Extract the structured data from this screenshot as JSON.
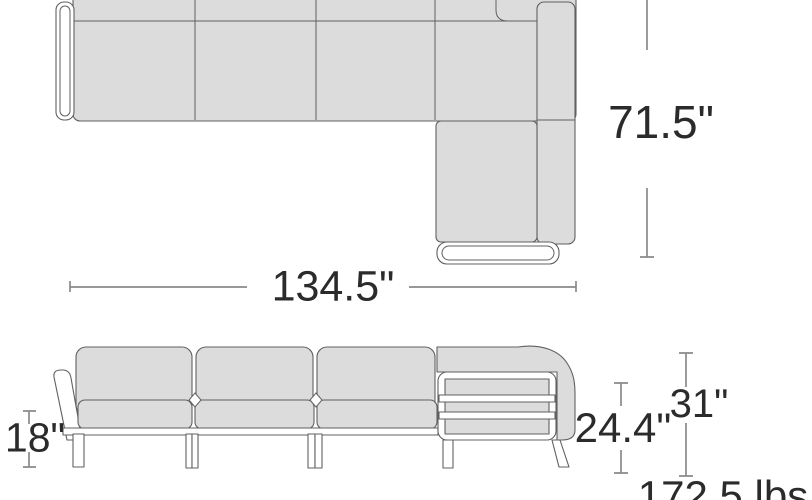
{
  "diagram": {
    "kind": "sectional-sofa-dimension-drawing",
    "views": [
      "top-view",
      "front-view"
    ]
  },
  "dimensions": {
    "overall_depth": {
      "label": "71.5\""
    },
    "overall_width": {
      "label": "134.5\""
    },
    "seat_height": {
      "label": "18\""
    },
    "arm_height": {
      "label": "24.4\""
    },
    "overall_height": {
      "label": "31\""
    },
    "weight": {
      "label": "172.5 lbs"
    }
  },
  "colors": {
    "background": "#ffffff",
    "cushion": "#dcdcdc",
    "outline": "#606060",
    "dimline": "#8a8a8a",
    "ink": "#2b2b2b",
    "frame": "#ffffff"
  }
}
